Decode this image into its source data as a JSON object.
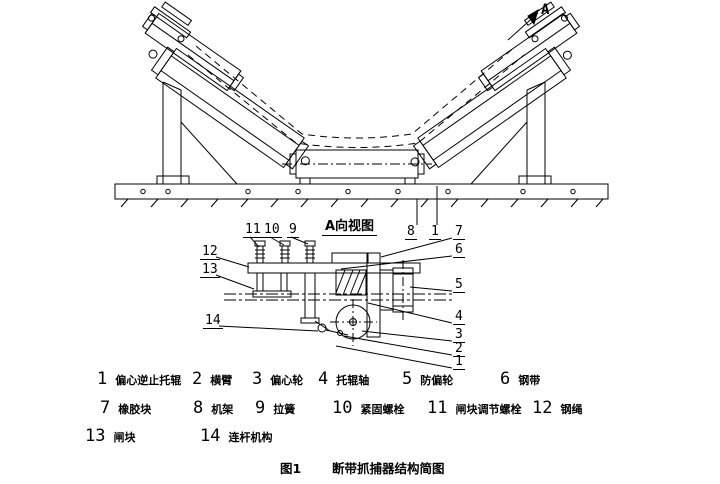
{
  "figure": {
    "caption_prefix": "图1",
    "caption_title": "断带抓捕器结构简图",
    "detail_view_label": "A向视图",
    "view_direction_label": "A"
  },
  "legend": {
    "items": [
      {
        "num": "1",
        "label": "偏心逆止托辊"
      },
      {
        "num": "2",
        "label": "横臂"
      },
      {
        "num": "3",
        "label": "偏心轮"
      },
      {
        "num": "4",
        "label": "托辊轴"
      },
      {
        "num": "5",
        "label": "防偏轮"
      },
      {
        "num": "6",
        "label": "钢带"
      },
      {
        "num": "7",
        "label": "橡胶块"
      },
      {
        "num": "8",
        "label": "机架"
      },
      {
        "num": "9",
        "label": "拉簧"
      },
      {
        "num": "10",
        "label": "紧固螺栓"
      },
      {
        "num": "11",
        "label": "闸块调节螺栓"
      },
      {
        "num": "12",
        "label": "钢绳"
      },
      {
        "num": "13",
        "label": "闸块"
      },
      {
        "num": "14",
        "label": "连杆机构"
      }
    ]
  },
  "callouts": {
    "top": [
      "11",
      "10",
      "9"
    ],
    "frame_refs": [
      "8",
      "1"
    ],
    "left": [
      "12",
      "13",
      "14"
    ],
    "right": [
      "7",
      "6",
      "5",
      "4",
      "3",
      "2",
      "1"
    ]
  },
  "colors": {
    "line": "#000000",
    "background": "#ffffff"
  }
}
